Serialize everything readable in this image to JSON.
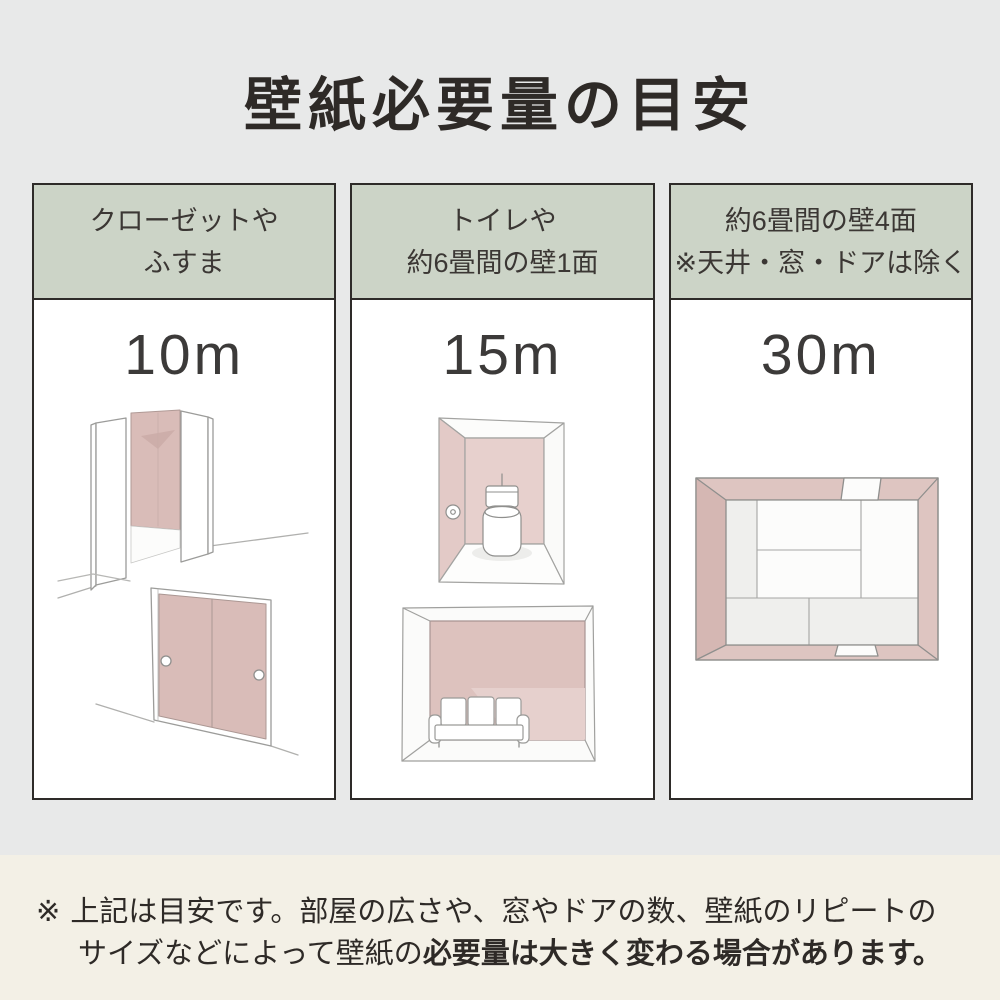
{
  "title": "壁紙必要量の目安",
  "columns": [
    {
      "header_line1": "クローゼットや",
      "header_line2": "ふすま",
      "value": "10m"
    },
    {
      "header_line1": "トイレや",
      "header_line2": "約6畳間の壁1面",
      "value": "15m"
    },
    {
      "header_line1": "約6畳間の壁4面",
      "header_line2": "※天井・窓・ドアは除く",
      "value": "30m"
    }
  ],
  "note": {
    "marker": "※",
    "line1": "上記は目安です。部屋の広さや、窓やドアの数、壁紙のリピートの",
    "line2_regular": "サイズなどによって壁紙の",
    "line2_bold": "必要量は大きく変わる場合があります。"
  },
  "colors": {
    "page_background": "#e8e9e9",
    "note_background": "#f3f0e6",
    "header_green": "#ccd4c7",
    "panel_white": "#ffffff",
    "border_dark": "#2e2b29",
    "text_dark": "#2e2a27",
    "wallpaper_pink": "#d9bcb8",
    "wallpaper_pink_dark": "#cdaeaa",
    "sketch_stroke": "#9c9c9a"
  }
}
